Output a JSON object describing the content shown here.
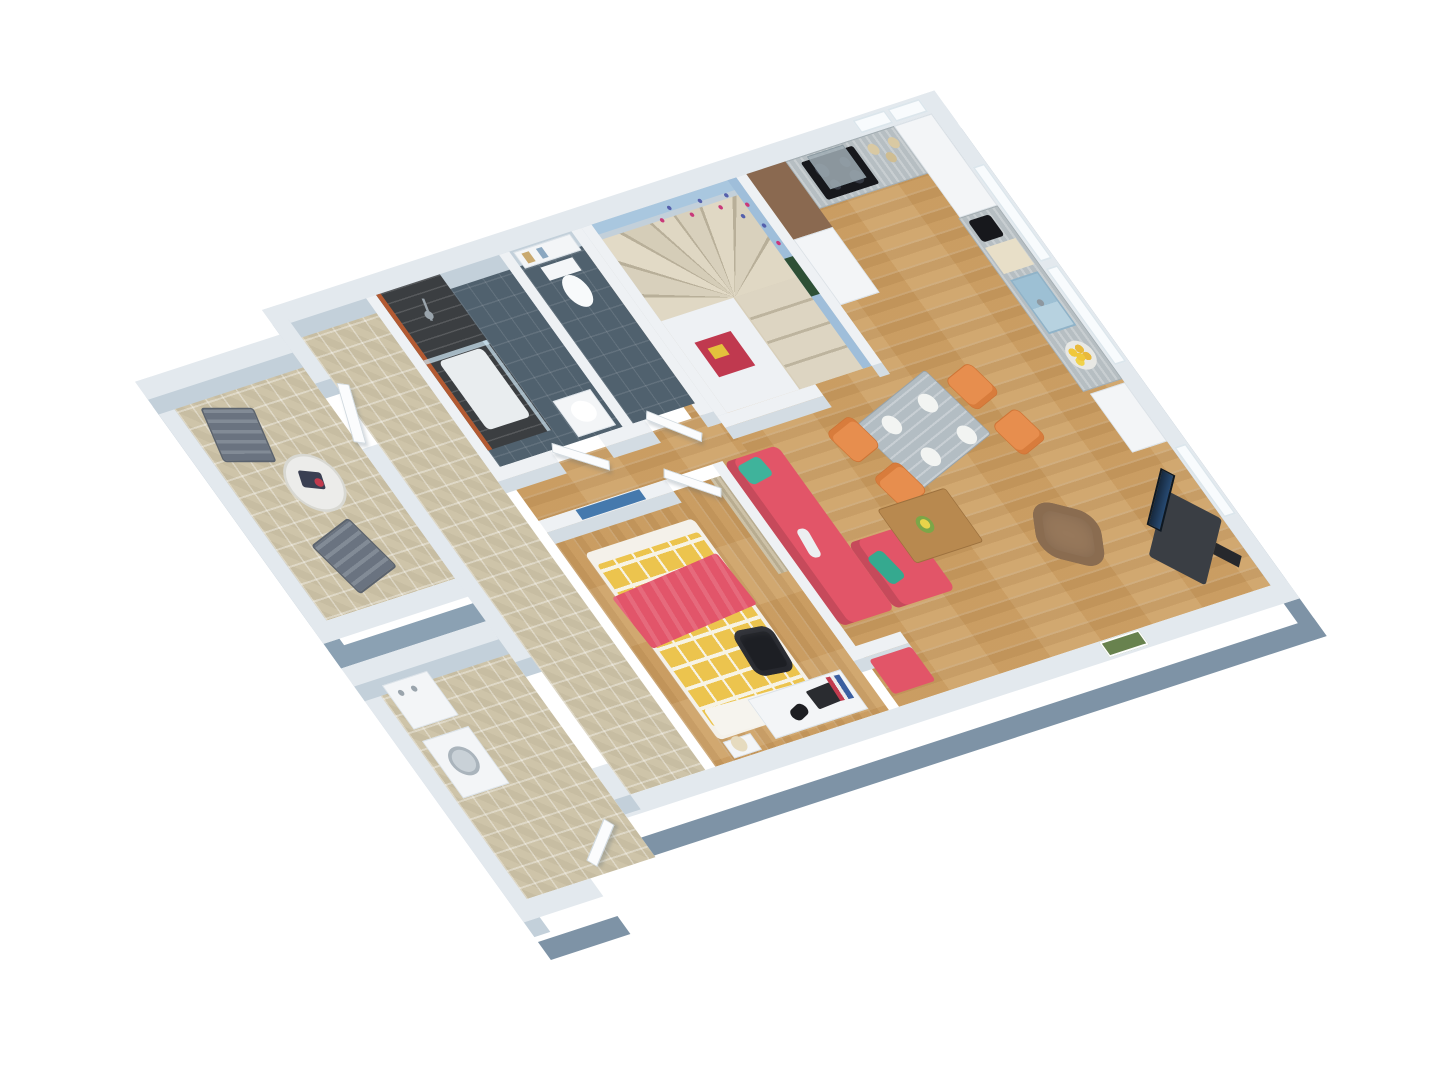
{
  "meta": {
    "description": "3D isometric rendering of a one-bedroom apartment floor plan, no visible text"
  },
  "scene": {
    "canvas": {
      "w": 1440,
      "h": 1080
    },
    "background": "#ffffff",
    "palette": {
      "wall_top": "#eef1f4",
      "outer_wall_top": "#e3e9ee",
      "wall_fascia": "#7e93a6",
      "wood_floor": "#cfa368",
      "cobble_floor": "#cec4a9",
      "bath_floor": "#50616e",
      "stair_wall_blue": "#a9c7df",
      "steps": "#ddd5c2",
      "sofa_red": "#e25568",
      "pillow_teal": "#3fb39b",
      "duvet_yellow": "#ecc44e",
      "chair_orange": "#e78e4e",
      "armchair_brown": "#97785b",
      "counter_gray": "#b6bec2",
      "sink_blue": "#9dc0d4",
      "cooktop_black": "#17181c"
    }
  },
  "plan": {
    "w": 1160,
    "h": 700,
    "matrix": [
      0.723,
      -0.236,
      0.589,
      0.819,
      95.7,
      364.3
    ]
  },
  "rooms": [
    "terrace",
    "entry-hall",
    "utility-room",
    "bathroom",
    "wc",
    "staircase",
    "kitchen",
    "dining-area",
    "living-room",
    "bedroom",
    "corridor"
  ],
  "items": [
    {
      "n": "floor-living-kitchen",
      "c": "floor-wood",
      "x": 624,
      "y": 22,
      "w": 514,
      "h": 576
    },
    {
      "n": "floor-corridor",
      "c": "floor-wood",
      "x": 370,
      "y": 246,
      "w": 290,
      "h": 52
    },
    {
      "n": "floor-bedroom",
      "c": "floor-woody",
      "x": 370,
      "y": 312,
      "w": 240,
      "h": 286
    },
    {
      "n": "floor-hall",
      "c": "floor-cobble",
      "x": 252,
      "y": 22,
      "w": 104,
      "h": 576
    },
    {
      "n": "floor-bathroom",
      "c": "floor-slate",
      "x": 370,
      "y": 22,
      "w": 170,
      "h": 210
    },
    {
      "n": "floor-wc",
      "c": "floor-slate",
      "x": 554,
      "y": 22,
      "w": 86,
      "h": 210
    },
    {
      "n": "floor-staircase",
      "x": 668,
      "y": 22,
      "w": 200,
      "h": 230,
      "b": "#d8cfba"
    },
    {
      "n": "floor-terrace",
      "c": "floor-cobble",
      "x": 52,
      "y": 52,
      "w": 178,
      "h": 276
    },
    {
      "n": "floor-utility",
      "c": "floor-cobble",
      "x": 52,
      "y": 402,
      "w": 178,
      "h": 266
    },
    {
      "n": "stair-winder-steps",
      "c": "steps-fan",
      "x": 668,
      "y": 22,
      "w": 200,
      "h": 118
    },
    {
      "n": "stair-straight-flight",
      "c": "steps-flight",
      "x": 770,
      "y": 140,
      "w": 98,
      "h": 112
    },
    {
      "n": "understair-block",
      "x": 668,
      "y": 140,
      "w": 100,
      "h": 112,
      "b": "#eef1f4"
    },
    {
      "n": "wall-north",
      "c": "wall-outer",
      "x": 230,
      "y": 0,
      "w": 930,
      "h": 22
    },
    {
      "n": "wall-east",
      "c": "wall-outer fascia",
      "x": 1138,
      "y": 0,
      "w": 22,
      "h": 620
    },
    {
      "n": "wall-south",
      "c": "wall-outer fascia",
      "x": 230,
      "y": 598,
      "w": 930,
      "h": 22
    },
    {
      "n": "wall-west-a",
      "c": "wall-outer",
      "x": 230,
      "y": 0,
      "w": 22,
      "h": 90
    },
    {
      "n": "wall-west-b",
      "c": "wall-outer",
      "x": 230,
      "y": 170,
      "w": 22,
      "h": 260
    },
    {
      "n": "wall-west-c",
      "c": "wall-outer",
      "x": 230,
      "y": 560,
      "w": 22,
      "h": 38
    },
    {
      "n": "terrace-wall-west",
      "c": "wall-outer fascia-sm",
      "x": 30,
      "y": 30,
      "w": 22,
      "h": 320
    },
    {
      "n": "terrace-wall-north",
      "c": "wall-outer",
      "x": 30,
      "y": 30,
      "w": 200,
      "h": 22
    },
    {
      "n": "terrace-wall-south",
      "c": "wall-outer fascia-sm",
      "x": 30,
      "y": 328,
      "w": 200,
      "h": 22
    },
    {
      "n": "utility-wall-west",
      "c": "wall-outer",
      "x": 30,
      "y": 380,
      "w": 22,
      "h": 310
    },
    {
      "n": "utility-wall-north",
      "c": "wall-outer",
      "x": 30,
      "y": 380,
      "w": 200,
      "h": 22
    },
    {
      "n": "utility-wall-south",
      "c": "wall-outer fascia",
      "x": 30,
      "y": 668,
      "w": 110,
      "h": 22
    },
    {
      "n": "bath-wall-west",
      "c": "wall",
      "x": 356,
      "y": 22,
      "w": 14,
      "h": 224
    },
    {
      "n": "bath-wc-divider",
      "c": "wall",
      "x": 540,
      "y": 22,
      "w": 14,
      "h": 210
    },
    {
      "n": "wc-wall-east",
      "c": "wall",
      "x": 640,
      "y": 22,
      "w": 14,
      "h": 224
    },
    {
      "n": "bath-wall-south-a",
      "c": "wall",
      "x": 356,
      "y": 232,
      "w": 84,
      "h": 14
    },
    {
      "n": "bath-wall-south-b",
      "c": "wall",
      "x": 505,
      "y": 232,
      "w": 65,
      "h": 14
    },
    {
      "n": "bath-wall-south-c",
      "c": "wall",
      "x": 635,
      "y": 232,
      "w": 19,
      "h": 14
    },
    {
      "n": "bedroom-wall-north",
      "c": "wall",
      "x": 370,
      "y": 298,
      "w": 175,
      "h": 14
    },
    {
      "n": "partition-bedroom-living",
      "c": "wall",
      "x": 610,
      "y": 298,
      "w": 14,
      "h": 226
    },
    {
      "n": "stub-wall-bench-nook",
      "c": "wall",
      "x": 610,
      "y": 524,
      "w": 76,
      "h": 14
    },
    {
      "n": "stair-wall-west",
      "c": "wall",
      "x": 654,
      "y": 22,
      "w": 14,
      "h": 230
    },
    {
      "n": "stair-wall-east",
      "c": "wall",
      "x": 868,
      "y": 22,
      "w": 14,
      "h": 230
    },
    {
      "n": "stair-wall-south",
      "c": "wall",
      "x": 654,
      "y": 252,
      "w": 136,
      "h": 14
    },
    {
      "n": "stair-blue-wall-north",
      "x": 668,
      "y": 22,
      "w": 200,
      "h": 12,
      "b": "#a9c7df"
    },
    {
      "n": "stair-blue-wall-east",
      "x": 856,
      "y": 22,
      "w": 12,
      "h": 230,
      "b": "#9fbeda"
    },
    {
      "n": "butterfly-decal-1",
      "c": "dot",
      "x": 748,
      "y": 38,
      "w": 5,
      "h": 5,
      "b": "#c9397a"
    },
    {
      "n": "butterfly-decal-2",
      "c": "dot",
      "x": 766,
      "y": 28,
      "w": 5,
      "h": 5,
      "b": "#5560ac"
    },
    {
      "n": "butterfly-decal-3",
      "c": "dot",
      "x": 786,
      "y": 42,
      "w": 5,
      "h": 5,
      "b": "#c9397a"
    },
    {
      "n": "butterfly-decal-4",
      "c": "dot",
      "x": 806,
      "y": 31,
      "w": 5,
      "h": 5,
      "b": "#5560ac"
    },
    {
      "n": "butterfly-decal-5",
      "c": "dot",
      "x": 824,
      "y": 44,
      "w": 5,
      "h": 5,
      "b": "#c9397a"
    },
    {
      "n": "butterfly-decal-6",
      "c": "dot",
      "x": 840,
      "y": 34,
      "w": 5,
      "h": 5,
      "b": "#5560ac"
    },
    {
      "n": "butterfly-decal-7",
      "c": "dot",
      "x": 856,
      "y": 50,
      "w": 5,
      "h": 5,
      "b": "#c9397a"
    },
    {
      "n": "butterfly-decal-8",
      "c": "dot",
      "x": 858,
      "y": 76,
      "w": 5,
      "h": 5,
      "b": "#5560ac"
    },
    {
      "n": "butterfly-decal-9",
      "c": "dot",
      "x": 860,
      "y": 98,
      "w": 5,
      "h": 5,
      "b": "#c9397a"
    },
    {
      "n": "butterfly-decal-10",
      "c": "dot",
      "x": 842,
      "y": 60,
      "w": 5,
      "h": 5,
      "b": "#5560ac"
    },
    {
      "n": "poster-stair-green",
      "x": 856,
      "y": 118,
      "w": 12,
      "h": 46,
      "b": "#2e5036"
    },
    {
      "n": "poster-stair-red",
      "x": 688,
      "y": 172,
      "w": 50,
      "h": 42,
      "b": "#c0394f"
    },
    {
      "n": "poster-stair-red-detail",
      "x": 698,
      "y": 182,
      "w": 20,
      "h": 13,
      "b": "#e3c23c"
    },
    {
      "n": "art-bedroom-wall",
      "x": 420,
      "y": 299,
      "w": 88,
      "h": 12,
      "b": "#4579ad"
    },
    {
      "n": "picture-living-east",
      "c": "pic",
      "x": 1141,
      "y": 436,
      "w": 15,
      "h": 42,
      "b": "#5a7748"
    },
    {
      "n": "picture-living-south",
      "c": "pic",
      "x": 900,
      "y": 599,
      "w": 54,
      "h": 18,
      "b": "#68824e"
    },
    {
      "n": "window-north-1",
      "c": "window",
      "x": 1044,
      "y": 3,
      "w": 44,
      "h": 16
    },
    {
      "n": "window-north-2",
      "c": "window",
      "x": 1092,
      "y": 3,
      "w": 44,
      "h": 16
    },
    {
      "n": "window-east-1",
      "c": "window",
      "x": 1141,
      "y": 88,
      "w": 16,
      "h": 116
    },
    {
      "n": "window-east-2",
      "c": "window",
      "x": 1141,
      "y": 212,
      "w": 16,
      "h": 118
    },
    {
      "n": "window-east-3",
      "c": "window",
      "x": 1141,
      "y": 430,
      "w": 16,
      "h": 86
    },
    {
      "n": "shower-area",
      "c": "shower",
      "x": 370,
      "y": 22,
      "w": 88,
      "h": 190
    },
    {
      "n": "shower-accent-strip",
      "x": 370,
      "y": 22,
      "w": 6,
      "h": 190,
      "b": "#b35a32"
    },
    {
      "n": "shower-tray",
      "x": 386,
      "y": 108,
      "w": 60,
      "h": 84,
      "b": "#e9edef",
      "rd": 6
    },
    {
      "n": "shower-glass-panel-1",
      "c": "glass",
      "x": 370,
      "y": 102,
      "w": 88,
      "h": 5
    },
    {
      "n": "shower-glass-panel-2",
      "c": "glass",
      "x": 452,
      "y": 102,
      "w": 5,
      "h": 110
    },
    {
      "n": "shower-head",
      "c": "dot",
      "x": 408,
      "y": 54,
      "w": 10,
      "h": 10,
      "b": "#9aa4ac"
    },
    {
      "n": "shower-rail",
      "x": 414,
      "y": 40,
      "w": 3,
      "h": 26,
      "b": "#9aa4ac",
      "r": 18
    },
    {
      "n": "bath-cabinet",
      "c": "cab",
      "x": 482,
      "y": 184,
      "w": 52,
      "h": 44
    },
    {
      "n": "bath-basin",
      "c": "dot",
      "x": 494,
      "y": 192,
      "w": 30,
      "h": 24,
      "b": "#ffffff"
    },
    {
      "n": "wc-shelf",
      "c": "cab",
      "x": 558,
      "y": 24,
      "w": 78,
      "h": 20
    },
    {
      "n": "wc-shelf-deco-1",
      "x": 566,
      "y": 28,
      "w": 10,
      "h": 12,
      "b": "#c9a96f"
    },
    {
      "n": "wc-shelf-deco-2",
      "x": 586,
      "y": 28,
      "w": 8,
      "h": 12,
      "b": "#8aa7c0"
    },
    {
      "n": "toilet-tank",
      "x": 576,
      "y": 48,
      "w": 44,
      "h": 16,
      "b": "#f4f6f8"
    },
    {
      "n": "toilet-bowl",
      "c": "dot",
      "x": 584,
      "y": 64,
      "w": 30,
      "h": 38,
      "b": "#f8fafb"
    },
    {
      "n": "kitchen-tall-cabinet-brown",
      "x": 882,
      "y": 22,
      "w": 54,
      "h": 80,
      "b": "#8a6950"
    },
    {
      "n": "kitchen-unit-white",
      "c": "cab",
      "x": 882,
      "y": 102,
      "w": 54,
      "h": 80
    },
    {
      "n": "kitchen-counter-north",
      "c": "counter",
      "x": 936,
      "y": 22,
      "w": 202,
      "h": 58
    },
    {
      "n": "cooktop",
      "c": "cooktop",
      "x": 952,
      "y": 28,
      "w": 72,
      "h": 46
    },
    {
      "n": "range-hood",
      "c": "hood",
      "x": 964,
      "y": 24,
      "w": 50,
      "h": 40,
      "b": "rgba(160,173,180,.85)"
    },
    {
      "n": "jar-1",
      "c": "dot",
      "x": 1038,
      "y": 32,
      "w": 13,
      "h": 13,
      "b": "#d9c9a3"
    },
    {
      "n": "jar-2",
      "c": "dot",
      "x": 1052,
      "y": 46,
      "w": 12,
      "h": 12,
      "b": "#cfbd92"
    },
    {
      "n": "jar-3",
      "c": "dot",
      "x": 1066,
      "y": 32,
      "w": 13,
      "h": 13,
      "b": "#d9c9a3"
    },
    {
      "n": "kitchen-tall-cabinet-corner",
      "c": "cab",
      "x": 1086,
      "y": 22,
      "w": 52,
      "h": 112
    },
    {
      "n": "kitchen-counter-east",
      "c": "counter",
      "x": 1084,
      "y": 134,
      "w": 54,
      "h": 212
    },
    {
      "n": "coffee-machine",
      "x": 1092,
      "y": 140,
      "w": 30,
      "h": 26,
      "b": "#17181c",
      "rd": 4
    },
    {
      "n": "pastry-board",
      "c": "pastries",
      "x": 1090,
      "y": 172,
      "w": 42,
      "h": 32,
      "b": "#e8dfc8"
    },
    {
      "n": "kitchen-sink",
      "c": "sink",
      "x": 1092,
      "y": 212,
      "w": 38,
      "h": 66
    },
    {
      "n": "sink-faucet",
      "c": "dot",
      "x": 1104,
      "y": 240,
      "w": 8,
      "h": 8,
      "b": "#8e98a0"
    },
    {
      "n": "lemon-bowl",
      "c": "bowl",
      "x": 1094,
      "y": 292,
      "w": 34,
      "h": 34
    },
    {
      "n": "white-pier-east",
      "c": "cab",
      "x": 1090,
      "y": 350,
      "w": 48,
      "h": 72
    },
    {
      "n": "dining-table",
      "c": "table-gray",
      "x": 810,
      "y": 288,
      "w": 128,
      "h": 88,
      "r": -15,
      "rd": 4
    },
    {
      "n": "plate-1",
      "c": "dot",
      "x": 832,
      "y": 306,
      "w": 22,
      "h": 22,
      "b": "#f2f4f2"
    },
    {
      "n": "plate-2",
      "c": "dot",
      "x": 890,
      "y": 296,
      "w": 22,
      "h": 22,
      "b": "#f2f4f2"
    },
    {
      "n": "plate-3",
      "c": "dot",
      "x": 850,
      "y": 350,
      "w": 22,
      "h": 22,
      "b": "#f2f4f2"
    },
    {
      "n": "plate-4",
      "c": "dot",
      "x": 908,
      "y": 340,
      "w": 22,
      "h": 22,
      "b": "#f2f4f2"
    },
    {
      "n": "dining-chair-1",
      "c": "chair-orange",
      "x": 766,
      "y": 298,
      "w": 44,
      "h": 42,
      "r": -15,
      "rd": 8
    },
    {
      "n": "dining-chair-2",
      "c": "chair-orange",
      "x": 782,
      "y": 358,
      "w": 44,
      "h": 42,
      "r": -15,
      "rd": 8
    },
    {
      "n": "dining-chair-3",
      "c": "chair-orange",
      "x": 942,
      "y": 284,
      "w": 44,
      "h": 42,
      "r": 165,
      "rd": 8
    },
    {
      "n": "dining-chair-4",
      "c": "chair-orange",
      "x": 958,
      "y": 344,
      "w": 44,
      "h": 42,
      "r": 165,
      "rd": 8
    },
    {
      "n": "sofa-main",
      "c": "sofa",
      "x": 624,
      "y": 300,
      "w": 74,
      "h": 200,
      "rd": 8
    },
    {
      "n": "sofa-chaise",
      "c": "sofa",
      "x": 698,
      "y": 420,
      "w": 84,
      "h": 80,
      "rd": 8
    },
    {
      "n": "sofa-pillow-1",
      "x": 636,
      "y": 306,
      "w": 34,
      "h": 24,
      "b": "#3fb39b",
      "r": -8,
      "rd": 6
    },
    {
      "n": "sofa-pillow-2",
      "x": 704,
      "y": 444,
      "w": 36,
      "h": 24,
      "b": "#35a98f",
      "r": 78,
      "rd": 6
    },
    {
      "n": "sofa-remote",
      "x": 648,
      "y": 390,
      "w": 14,
      "h": 34,
      "b": "#eceff1",
      "r": 8,
      "rd": 6
    },
    {
      "n": "red-bench",
      "x": 628,
      "y": 542,
      "w": 58,
      "h": 42,
      "b": "#e25568",
      "rd": 4
    },
    {
      "n": "coffee-table",
      "c": "table-wood",
      "x": 758,
      "y": 396,
      "w": 94,
      "h": 66,
      "rd": 4
    },
    {
      "n": "flower-vase",
      "c": "dot",
      "x": 790,
      "y": 416,
      "w": 20,
      "h": 20,
      "b": "#7ca648"
    },
    {
      "n": "flower-bloom",
      "c": "dot",
      "x": 795,
      "y": 420,
      "w": 11,
      "h": 11,
      "b": "#e8d44a"
    },
    {
      "n": "armchair",
      "c": "chair-brown",
      "x": 916,
      "y": 448,
      "w": 74,
      "h": 68,
      "r": 32,
      "rd": 24
    },
    {
      "n": "tv-stand",
      "x": 1034,
      "y": 492,
      "w": 94,
      "h": 62,
      "b": "#3a3e44",
      "r": -40,
      "rd": 4
    },
    {
      "n": "tv-screen",
      "c": "tv",
      "x": 1044,
      "y": 470,
      "w": 80,
      "h": 16,
      "r": -40
    },
    {
      "n": "tv-speaker",
      "x": 1106,
      "y": 540,
      "w": 16,
      "h": 28,
      "b": "#26282c",
      "r": -40
    },
    {
      "n": "bed-base",
      "x": 395,
      "y": 345,
      "w": 150,
      "h": 228,
      "b": "#f4f1ea",
      "rd": 6
    },
    {
      "n": "bed-duvet",
      "c": "duvet",
      "x": 400,
      "y": 360,
      "w": 140,
      "h": 198,
      "rd": 4
    },
    {
      "n": "bed-blanket",
      "c": "blanket",
      "x": 392,
      "y": 392,
      "w": 154,
      "h": 64,
      "r": -4,
      "rd": 4
    },
    {
      "n": "bed-sheet-foot",
      "x": 402,
      "y": 540,
      "w": 136,
      "h": 32,
      "b": "#f6f4ee",
      "r": 2,
      "rd": 4
    },
    {
      "n": "nightstand",
      "c": "cab",
      "x": 398,
      "y": 576,
      "w": 38,
      "h": 20
    },
    {
      "n": "bedside-lamp",
      "c": "dot",
      "x": 406,
      "y": 574,
      "w": 18,
      "h": 18,
      "b": "#e6dbbf"
    },
    {
      "n": "desk",
      "c": "cab",
      "x": 460,
      "y": 542,
      "w": 128,
      "h": 48
    },
    {
      "n": "desk-chair",
      "c": "chair-black",
      "x": 492,
      "y": 472,
      "w": 50,
      "h": 54,
      "r": 6,
      "rd": 12
    },
    {
      "n": "desk-laptop",
      "x": 532,
      "y": 552,
      "w": 34,
      "h": 22,
      "b": "#2a2c30",
      "r": -3,
      "rd": 2
    },
    {
      "n": "desk-books",
      "c": "books",
      "x": 564,
      "y": 546,
      "w": 18,
      "h": 28,
      "r": 4
    },
    {
      "n": "desk-lamp",
      "x": 496,
      "y": 564,
      "w": 24,
      "h": 14,
      "b": "#1d1e22",
      "r": -18,
      "rd": 7
    },
    {
      "n": "curtain-partition",
      "c": "curtain",
      "x": 596,
      "y": 312,
      "w": 14,
      "h": 116
    },
    {
      "n": "terrace-chair-1",
      "c": "chair-slat",
      "x": 72,
      "y": 84,
      "w": 62,
      "h": 64,
      "r": 16,
      "rd": 4
    },
    {
      "n": "terrace-chair-2",
      "c": "chair-slat",
      "x": 102,
      "y": 240,
      "w": 66,
      "h": 66,
      "r": -14,
      "rd": 4
    },
    {
      "n": "terrace-table",
      "c": "ring",
      "x": 116,
      "y": 154,
      "w": 68,
      "h": 68,
      "b": "#ececea"
    },
    {
      "n": "terrace-table-deco",
      "x": 136,
      "y": 174,
      "w": 26,
      "h": 20,
      "b": "#3a3f52",
      "r": 22,
      "rd": 3
    },
    {
      "n": "terrace-table-deco-red",
      "c": "dot",
      "x": 150,
      "y": 184,
      "w": 10,
      "h": 10,
      "b": "#c23b4e"
    },
    {
      "n": "utility-sink-unit",
      "c": "cab",
      "x": 62,
      "y": 410,
      "w": 62,
      "h": 54
    },
    {
      "n": "utility-tap-1",
      "c": "dot",
      "x": 74,
      "y": 420,
      "w": 7,
      "h": 7,
      "b": "#9aa4ac"
    },
    {
      "n": "utility-tap-2",
      "c": "dot",
      "x": 92,
      "y": 420,
      "w": 7,
      "h": 7,
      "b": "#9aa4ac"
    },
    {
      "n": "washing-machine",
      "c": "cab",
      "x": 62,
      "y": 478,
      "w": 64,
      "h": 70
    },
    {
      "n": "washer-door",
      "c": "ring2",
      "x": 76,
      "y": 494,
      "w": 34,
      "h": 34,
      "b": "#c9d1d7"
    },
    {
      "n": "door-terrace",
      "c": "door",
      "x": 240,
      "y": 96,
      "w": 14,
      "h": 70,
      "r": 24
    },
    {
      "n": "door-bathroom",
      "c": "door",
      "x": 438,
      "y": 242,
      "w": 62,
      "h": 12,
      "r": 36
    },
    {
      "n": "door-wc",
      "c": "door",
      "x": 568,
      "y": 242,
      "w": 60,
      "h": 12,
      "r": 42
    },
    {
      "n": "door-bedroom",
      "c": "door",
      "x": 542,
      "y": 304,
      "w": 62,
      "h": 12,
      "r": 38
    },
    {
      "n": "door-entrance",
      "c": "door",
      "x": 148,
      "y": 630,
      "w": 64,
      "h": 12,
      "r": -34
    }
  ]
}
